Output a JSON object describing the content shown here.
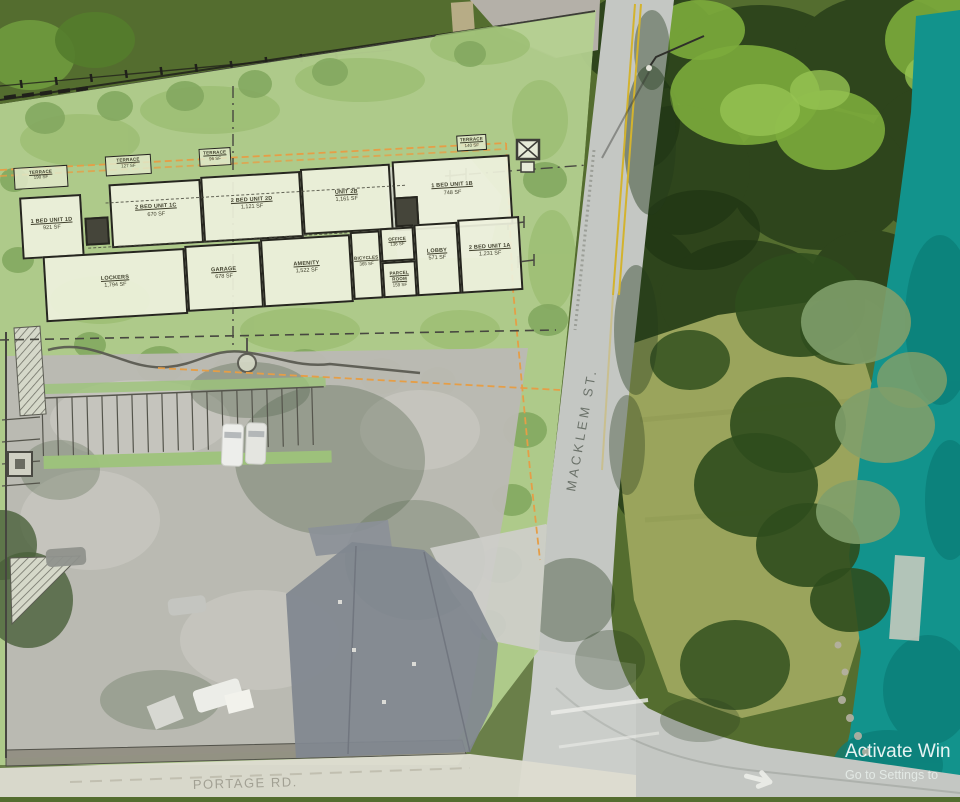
{
  "plan": {
    "streets": {
      "macklem": "MACKLEM ST.",
      "portage": "PORTAGE RD."
    },
    "rooms": [
      {
        "name": "1 BED UNIT 1D",
        "area": "921 SF"
      },
      {
        "name": "2 BED UNIT 1C",
        "area": "670 SF"
      },
      {
        "name": "2 BED UNIT 2D",
        "area": "1,121 SF"
      },
      {
        "name": "UNIT 2B",
        "area": "1,161 SF"
      },
      {
        "name": "1 BED UNIT 1B",
        "area": "748 SF"
      },
      {
        "name": "LOCKERS",
        "area": "1,794 SF"
      },
      {
        "name": "GARAGE",
        "area": "678 SF"
      },
      {
        "name": "AMENITY",
        "area": "1,522 SF"
      },
      {
        "name": "BICYCLES",
        "area": "365 SF"
      },
      {
        "name": "OFFICE",
        "area": "136 SF"
      },
      {
        "name": "PARCEL ROOM",
        "area": "159 SF"
      },
      {
        "name": "LOBBY",
        "area": "571 SF"
      },
      {
        "name": "2 BED UNIT 1A",
        "area": "1,231 SF"
      }
    ],
    "terraces": [
      {
        "name": "TERRACE",
        "area": "190 SF"
      },
      {
        "name": "TERRACE",
        "area": "127 SF"
      },
      {
        "name": "TERRACE",
        "area": "96 SF"
      },
      {
        "name": "TERRACE",
        "area": "140 SF"
      }
    ]
  },
  "watermark": {
    "line1": "Activate Win",
    "line2": "Go to Settings to"
  },
  "colors": {
    "water": "#12938c",
    "tree_canopy": "#2c431b",
    "lawn": "#9aa45c",
    "plan_grass": "#a9c97f",
    "road": "#c4c7c3",
    "setback_line": "#e2902c",
    "roof_dark": "#6f7680",
    "roof_light": "#c7c7c1"
  }
}
